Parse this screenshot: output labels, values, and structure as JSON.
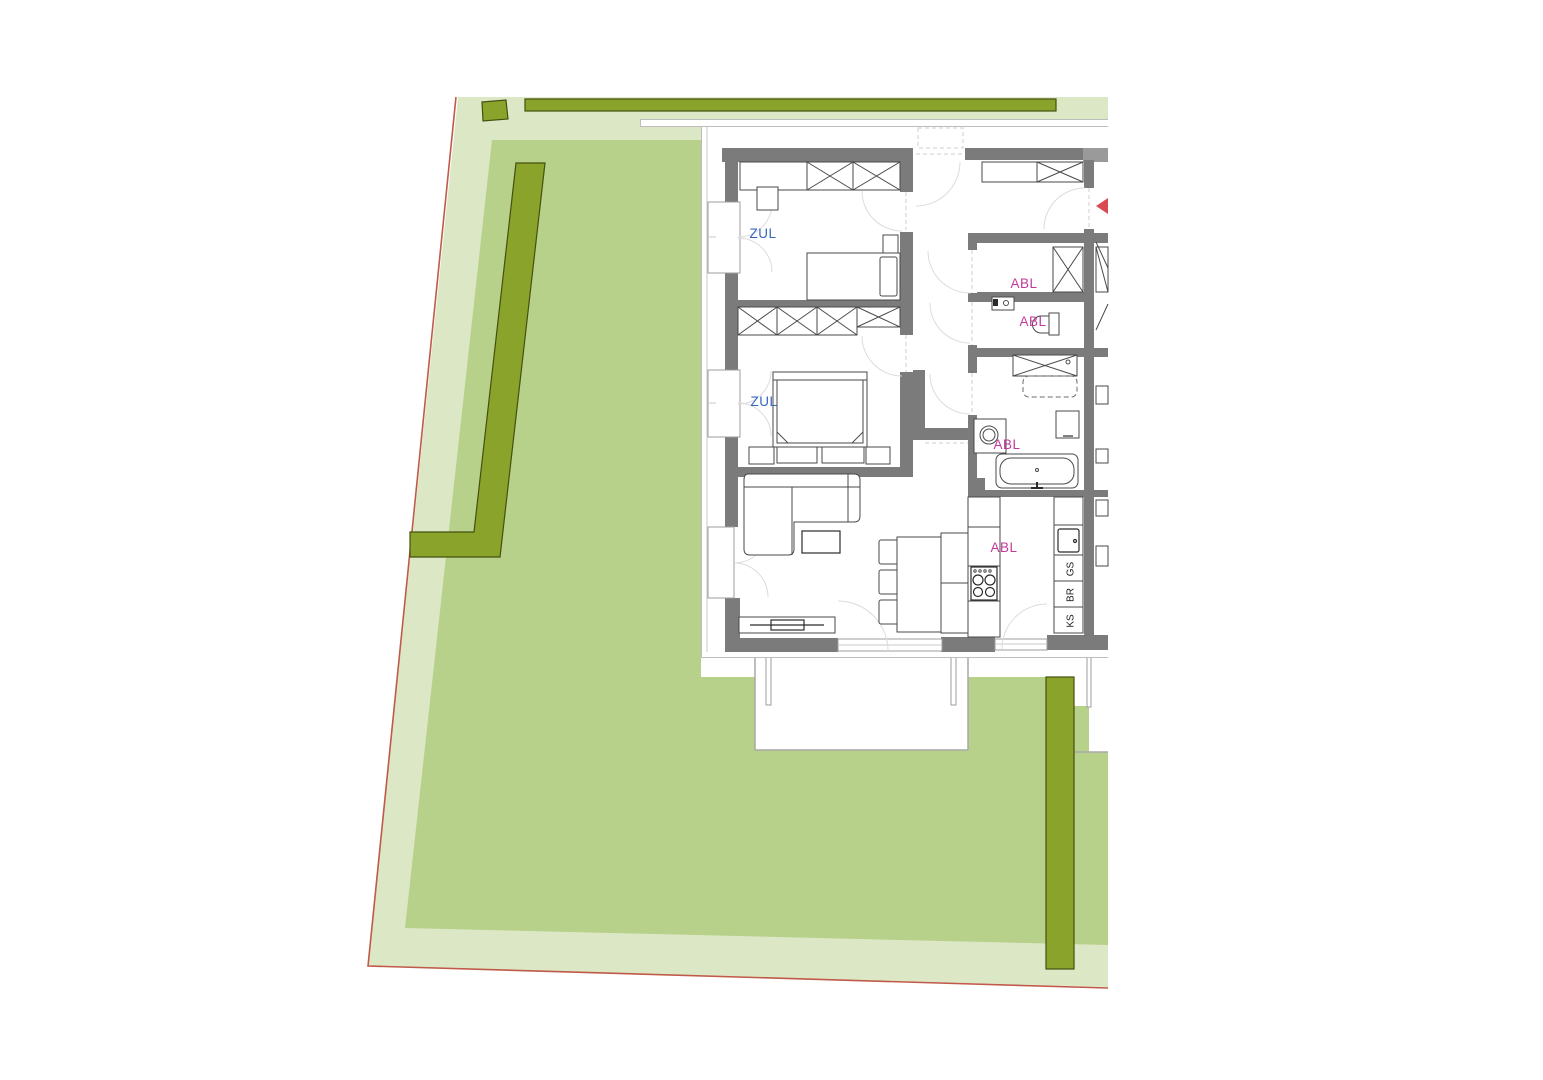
{
  "plan": {
    "supply_air_label_bedroom1": "ZUL",
    "supply_air_label_bedroom2": "ZUL",
    "exhaust_air_label_storage": "ABL",
    "exhaust_air_label_wc": "ABL",
    "exhaust_air_label_bath": "ABL",
    "exhaust_air_label_kitchen": "ABL",
    "appliance_dishwasher": "GS",
    "appliance_oven": "BR",
    "appliance_fridge": "KS"
  },
  "colors": {
    "lawn_light": "#dce8c5",
    "lawn_medium": "#b7d08a",
    "hedge": "#8aa32b",
    "hedge_outline": "#44500f",
    "boundary_line": "#c05a48",
    "wall": "#7b7b7b",
    "label_supply_air": "#3565c0",
    "label_exhaust_air": "#c13a9b",
    "entrance_arrow": "#d94b52"
  }
}
